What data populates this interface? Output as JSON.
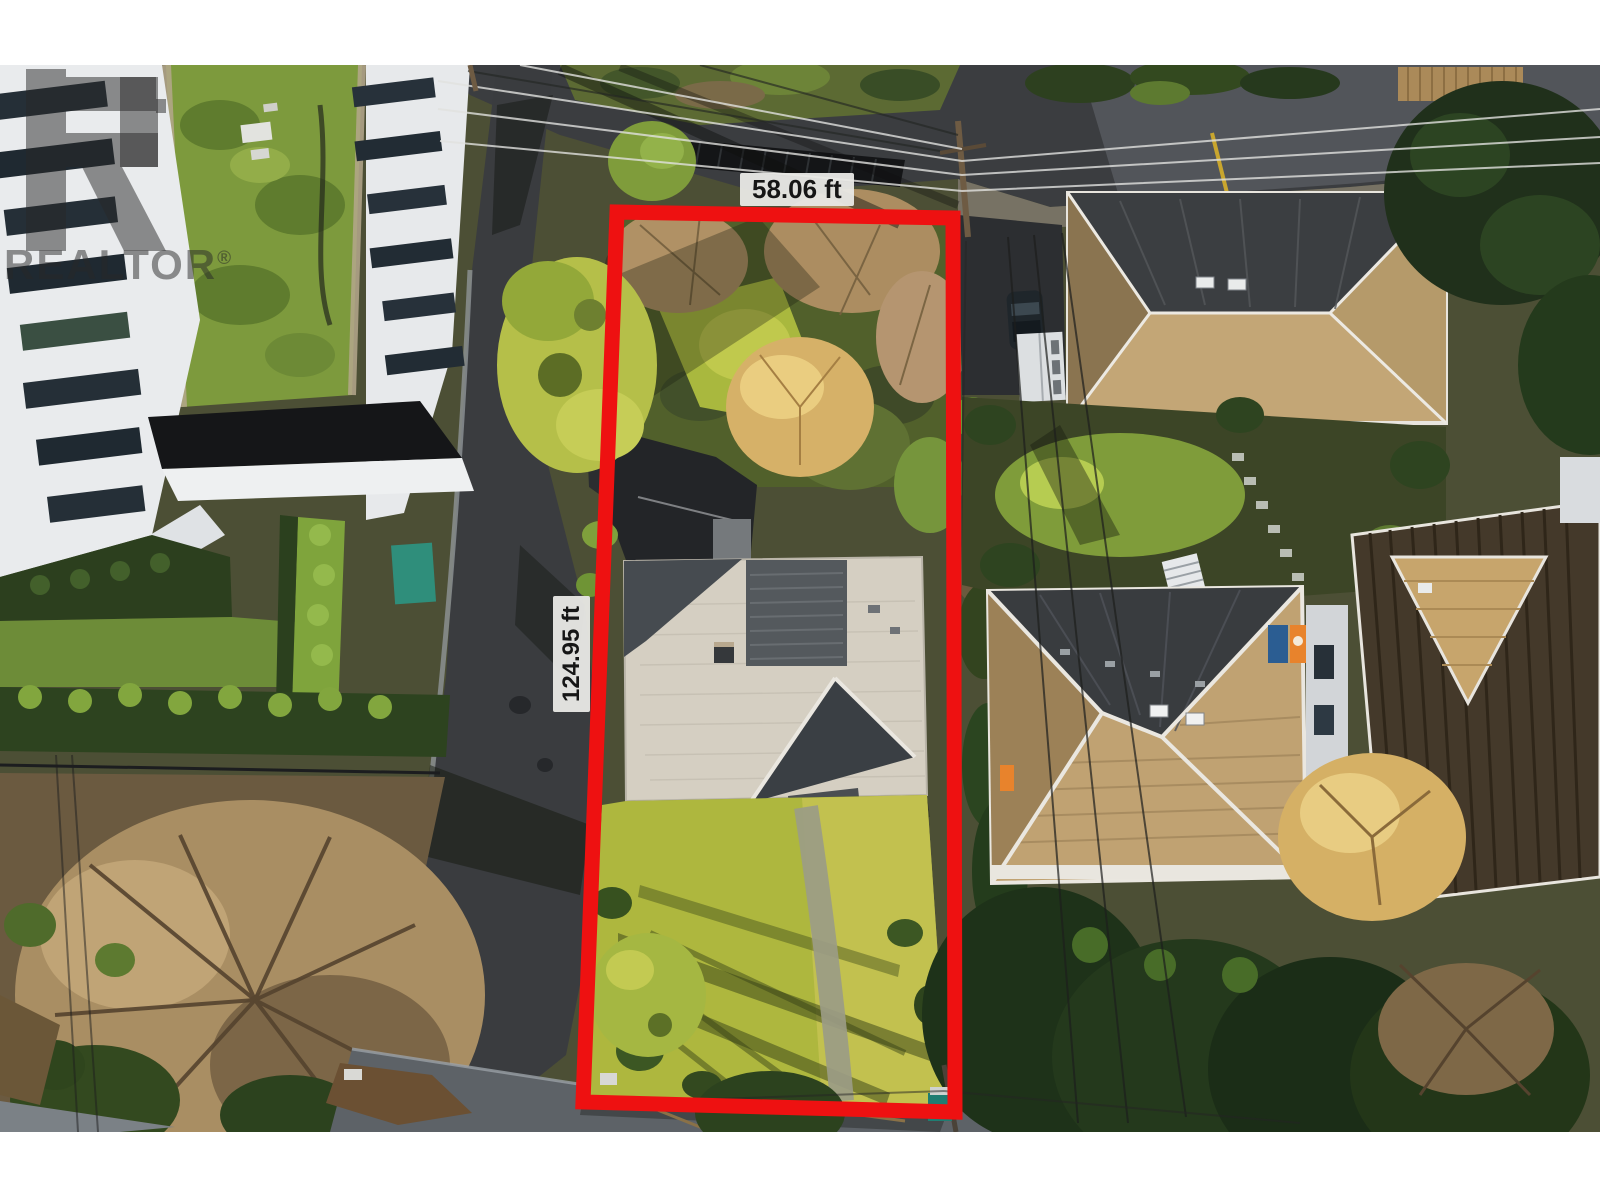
{
  "page": {
    "letterbox_color": "#ffffff"
  },
  "photo": {
    "kind": "aerial-drone-photo",
    "description": "Winter aerial view of a residential lot outlined in red: grey-roofed house with large front lawn; modern white condo building and street to the west, lane with power lines at top, brown hip-roof neighbour houses and gardens to the east, bare trees and conifers around",
    "palette": {
      "asphalt": "#3a3c3f",
      "asphalt_sunlit": "#5c6166",
      "lawn_bright": "#aeb73e",
      "lawn_dark": "#51602b",
      "bare_tree": "#a98e63",
      "conifer": "#20351a",
      "chartreuse_tree": "#b5bf49",
      "subject_roof_light": "#d5cfc2",
      "subject_roof_dark": "#3a3f44",
      "neighbor_roof_tan": "#c0a272",
      "neighbor_roof_dark": "#3a3d40",
      "condo_white": "#e9ebed",
      "marker_orange": "#e8832c",
      "tarp_teal": "#2f8e7b"
    }
  },
  "boundary": {
    "color": "#ee1111",
    "stroke_width_px": "15",
    "front_width_label": "58.06 ft",
    "side_depth_label": "124.95 ft",
    "label_background": "rgba(233,233,230,0.95)",
    "label_text_color": "#161616"
  },
  "watermark": {
    "text": "REALTOR",
    "registered_symbol": "®",
    "color": "rgba(40,40,40,0.5)"
  }
}
